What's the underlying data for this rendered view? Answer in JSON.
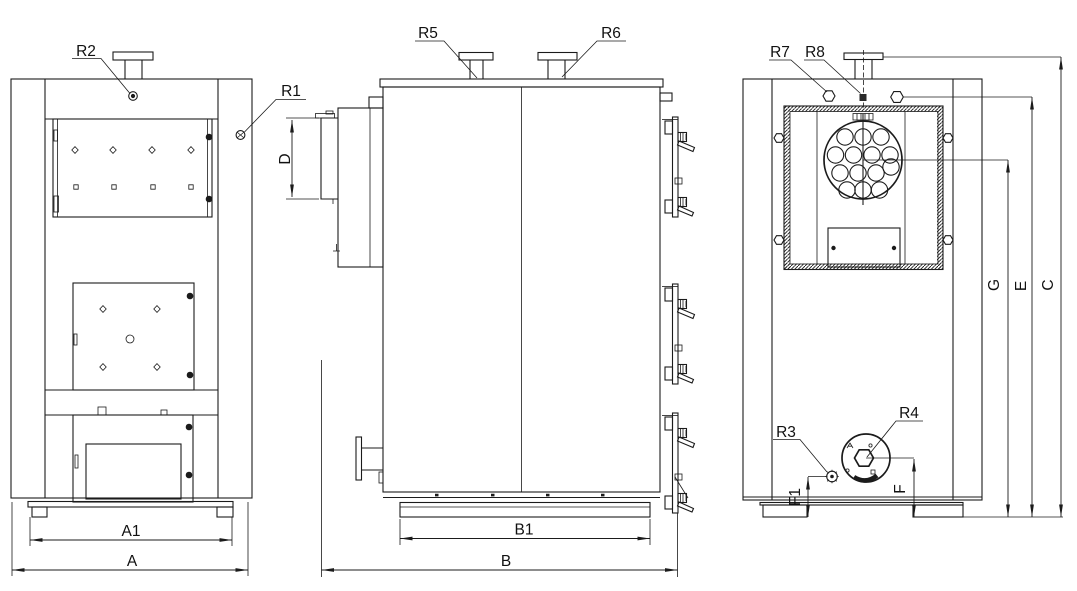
{
  "callouts": {
    "r1": "R1",
    "r2": "R2",
    "r3": "R3",
    "r4": "R4",
    "r5": "R5",
    "r6": "R6",
    "r7": "R7",
    "r8": "R8"
  },
  "dimensions": {
    "a": "A",
    "a1": "A1",
    "b": "B",
    "b1": "B1",
    "c": "C",
    "d": "D",
    "e": "E",
    "f": "F",
    "f1": "F1",
    "g": "G"
  },
  "colors": {
    "line": "#1b1b1b",
    "background": "#ffffff"
  }
}
